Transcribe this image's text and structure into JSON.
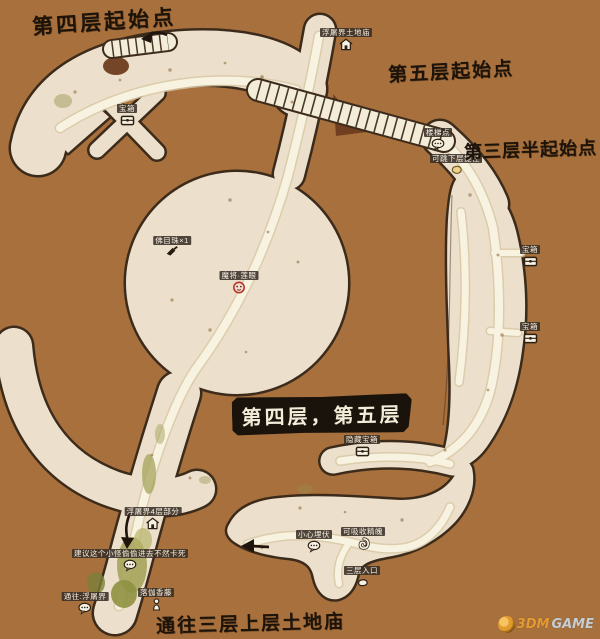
{
  "page": {
    "bg_color": "#a7703c"
  },
  "titles": {
    "floor4_start": "第四层起始点",
    "floor5_start": "第五层起始点",
    "floor3_half_start": "第三层半起始点",
    "floor_badge": "第四层，第五层",
    "bottom_exit": "通往三层上层土地庙"
  },
  "markers": [
    {
      "label": "宝箱",
      "icon": "chest-icon"
    },
    {
      "label": "浮屠界土地庙",
      "icon": "temple-icon"
    },
    {
      "label": "楼梯点",
      "icon": "speech-bubble-icon"
    },
    {
      "label": "可跳下层捷径",
      "icon": "item-icon"
    },
    {
      "label": "佛目珠×1",
      "icon": "buried-item-icon"
    },
    {
      "label": "魔将·莲眼",
      "icon": "boss-icon"
    },
    {
      "label": "隐藏宝箱",
      "icon": "chest-icon"
    },
    {
      "label": "宝箱",
      "icon": "chest-icon"
    },
    {
      "label": "宝箱",
      "icon": "chest-icon"
    },
    {
      "label": "浮屠界4层部分",
      "icon": "temple-icon"
    },
    {
      "label": "建议这个小怪偷偷进去不然卡死",
      "icon": "speech-bubble-icon"
    },
    {
      "label": "通往:浮屠界",
      "icon": "speech-bubble-icon"
    },
    {
      "label": "落伽香藤",
      "icon": "npc-icon"
    },
    {
      "label": "小心埋伏",
      "icon": "speech-bubble-icon"
    },
    {
      "label": "可吸收精魄",
      "icon": "spirit-icon"
    },
    {
      "label": "三层入口",
      "icon": "pickup-icon"
    }
  ],
  "watermark": {
    "brand": "3DM",
    "suffix": "GAME"
  },
  "colors": {
    "background": "#a7703c",
    "path_fill": "#ece0cc",
    "path_outline": "#3c2b1b",
    "walkway": "#f8f2e0",
    "moss_green": "#a6a45c",
    "badge_bg": "#19130c",
    "badge_text": "#f3ecd9",
    "title_text": "#1d1309",
    "marker_bg": "#3a2f25",
    "marker_text": "#f5efe2",
    "boss_red": "#b5372a",
    "watermark_orange": "#e59b31",
    "watermark_gray": "#c3ced6"
  }
}
